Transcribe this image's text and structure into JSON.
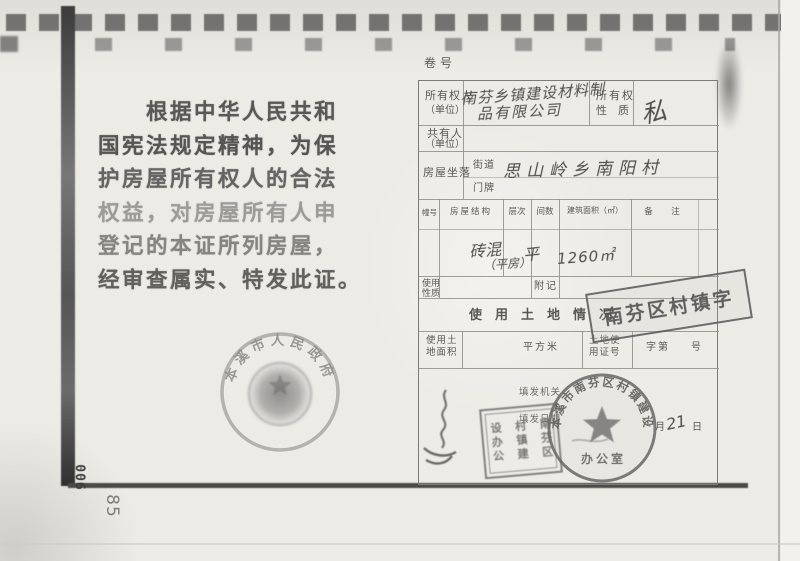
{
  "page": {
    "number": "85",
    "archive_code": "006"
  },
  "preamble": {
    "lines": [
      "　　根据中华人民共和",
      "国宪法规定精神，为保",
      "护房屋所有权人的合法",
      "权益，对房屋所有人申",
      "登记的本证所列房屋，",
      "经审查属实、特发此证。"
    ]
  },
  "gov_seal": {
    "arc_text": "本溪市人民政府"
  },
  "form": {
    "serial_label": "卷号",
    "owner_label1": "所有权人",
    "owner_label2": "（单位）",
    "owner_value_line1": "南芬乡镇建设材料制",
    "owner_value_line2": "品有限公司",
    "nature_label1": "所有权",
    "nature_label2": "性　质",
    "nature_value": "私",
    "coowner_label1": "共有人",
    "coowner_label2": "（单位）",
    "location_label": "房屋坐落",
    "street_label": "街道",
    "street_value": "思山岭乡南阳村",
    "plate_label": "门牌",
    "building_headers": [
      "幢号",
      "房屋结构",
      "层次",
      "间数",
      "建筑面积（㎡）",
      "备　注"
    ],
    "building_row": {
      "structure_line1": "砖混",
      "structure_line2": "（平房）",
      "floors": "平",
      "area": "1260㎡"
    },
    "usage_label1": "使用",
    "usage_label2": "性质",
    "fuji_label": "附记",
    "land_section_title": "使用土地情况",
    "land_area_label1": "使用土",
    "land_area_label2": "地面积",
    "land_unit": "平方米",
    "land_cert_label1": "土地使",
    "land_cert_label2": "用证号",
    "zi_label": "字第",
    "hao_label": "号",
    "issue_org_label": "填发机关",
    "issue_date_label": "填发日期",
    "month_label": "月",
    "day_label": "日",
    "day_value": "21"
  },
  "stamps": {
    "rect_stamp_text": "南芬区村镇字",
    "square_stamp_col1": "南芬区",
    "square_stamp_col2": "村镇建",
    "square_stamp_col3": "设办公",
    "round_stamp_arc": "本溪市南芬区村镇建设",
    "round_stamp_bottom": "办 公 室"
  },
  "colors": {
    "paper": "#edebe6",
    "ink": "#4e4d4b",
    "stamp_gray": "#5f5f5f",
    "frame_dark": "#3c3c3c"
  }
}
